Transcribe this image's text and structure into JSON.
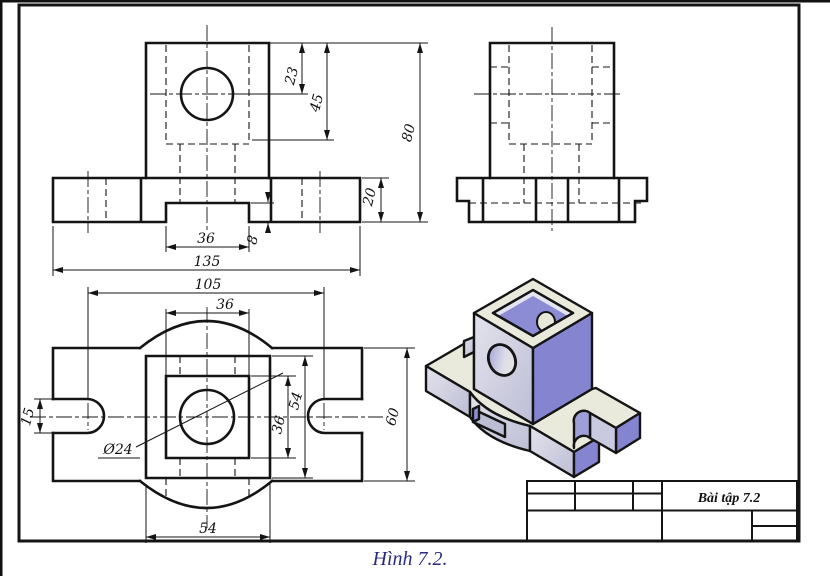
{
  "figure": {
    "caption": "Hình 7.2.",
    "title_block": {
      "title": "Bài tập 7.2"
    }
  },
  "front_view": {
    "d23": "23",
    "d45": "45",
    "d80": "80",
    "d20": "20",
    "d36_notch": "36",
    "d8": "8",
    "d135": "135"
  },
  "top_view": {
    "d105": "105",
    "d36_top": "36",
    "d15": "15",
    "dia24": "Ø24",
    "d36_inner": "36",
    "d54_square": "54",
    "d60": "60",
    "d54_bottom": "54"
  },
  "colors": {
    "outline": "#141414",
    "iso_top_face": "#eaeadc",
    "iso_left_face": "#d6d6e4",
    "iso_right_face": "#8484d1",
    "caption_text": "#2b2b80"
  }
}
